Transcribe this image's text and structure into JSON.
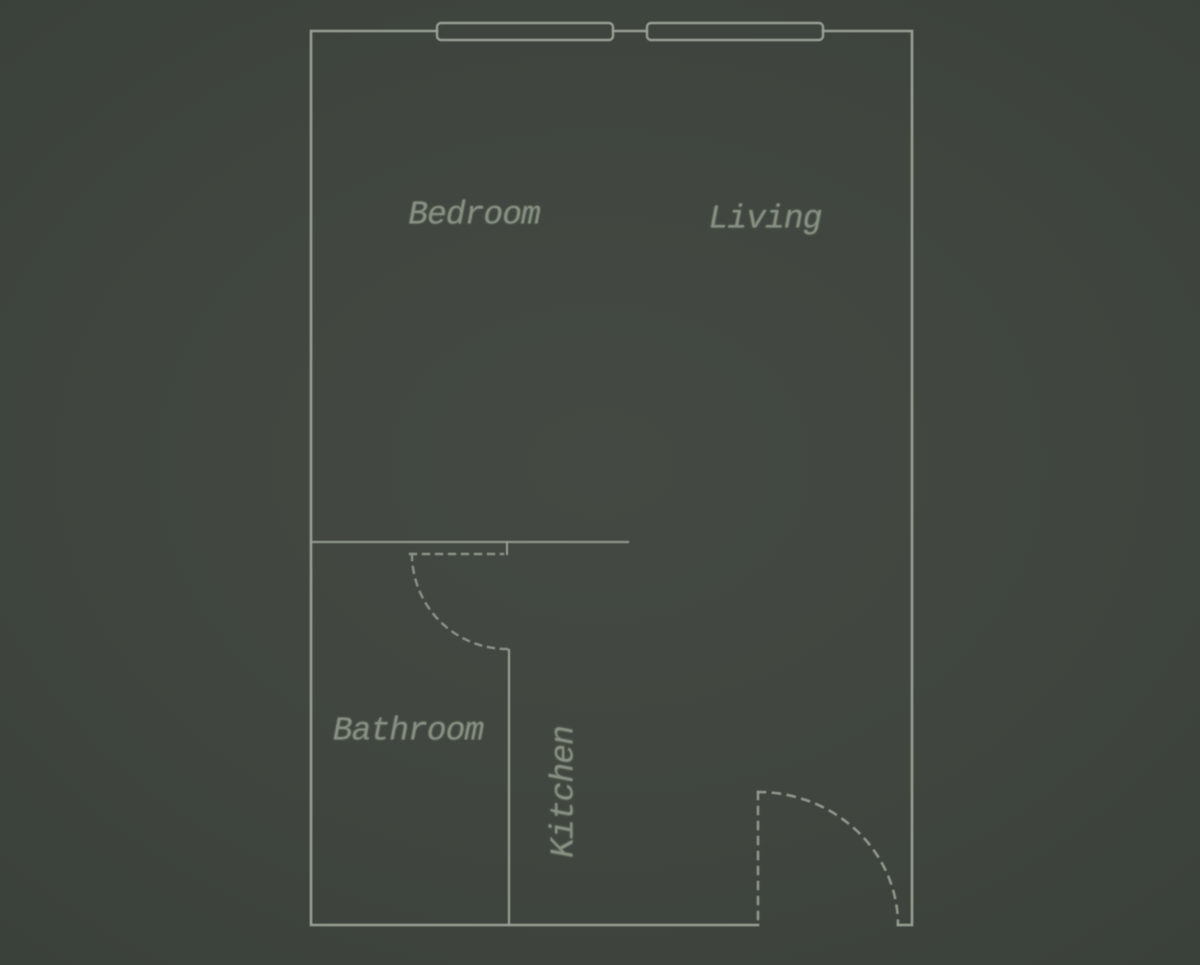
{
  "title": "Studio apartment floor plan",
  "colors": {
    "background": "#40463f",
    "wall": "#98a094",
    "text": "#879082"
  },
  "rooms": [
    {
      "id": "bedroom",
      "label": "Bedroom"
    },
    {
      "id": "living",
      "label": "Living"
    },
    {
      "id": "bathroom",
      "label": "Bathroom"
    },
    {
      "id": "kitchen",
      "label": "Kitchen"
    }
  ],
  "features": {
    "window_count": 2,
    "door_count": 2
  }
}
